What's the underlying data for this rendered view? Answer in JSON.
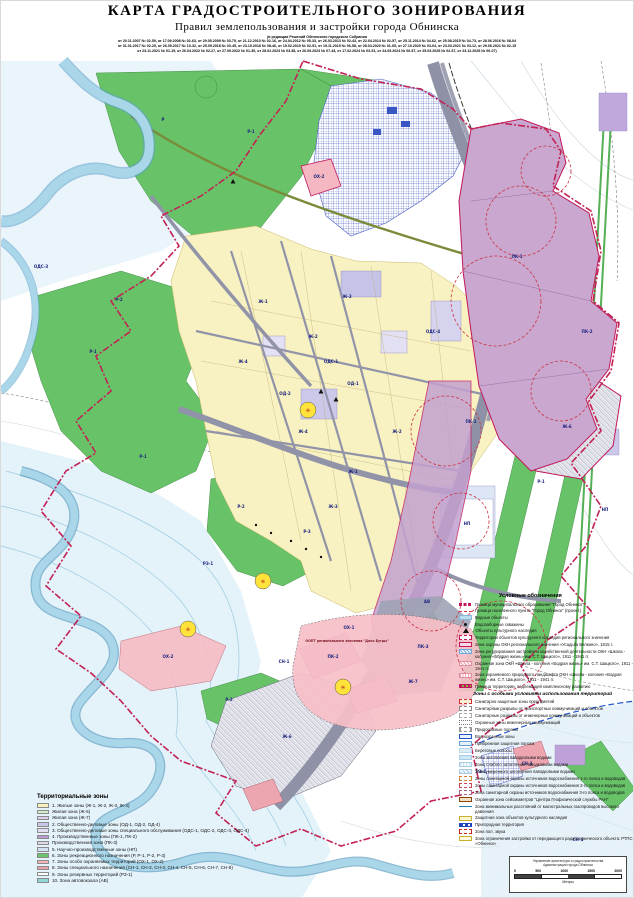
{
  "header": {
    "title": "КАРТА ГРАДОСТРОИТЕЛЬНОГО ЗОНИРОВАНИЯ",
    "subtitle": "Правил землепользования и застройки города  Обнинска",
    "edition_note": "(в редакции Решений Обнинского городского Собрания",
    "amendments_line1": "от 20.11.2007 № 02-50, от 17.09.2008 № 02-63, от 29.05.2009 № 03-75, от 21.12.2010 № 02-16, от 24.04.2012 № 05-33, от 26.03.2013 № 02-43, от 22.04.2014 № 02-57, от 25.11.2014 № 04-62, от 25.08.2015 № 04-73, от 28.06.2016 № 08-04",
    "amendments_line2": "от 31.01.2017 № 02-25, от 26.09.2017 № 10-32, от 25.09.2018 № 03-45, от 23.10.2018 № 08-46, от 19.02.2019 № 02-51, от 19.11.2019 № 06-58, от 28.04.2020 № 01-65, от 27.10.2020 № 03-04, от 23.03.2021 № 03-12, от 29.06.2021 № 02-15",
    "amendments_line3": "от 23.11.2021 № 01-19, от 26.04.2022 № 02-27, от 27.09.2022 № 01-30, от 28.02.2023 № 03-38, от 26.09.2023 № 07-43, от 17.02.2024 № 03-51, от 24.09.2024 № 06-97, от 25.03.2025 № 02-67, от 23.12.2025 № 06-07)"
  },
  "map": {
    "zone_labels": [
      {
        "t": "Р-1",
        "x": 250,
        "y": 132
      },
      {
        "t": "Р",
        "x": 162,
        "y": 120
      },
      {
        "t": "Р-1",
        "x": 92,
        "y": 352
      },
      {
        "t": "Р-1",
        "x": 142,
        "y": 457
      },
      {
        "t": "Р-2",
        "x": 118,
        "y": 300
      },
      {
        "t": "Р-2",
        "x": 240,
        "y": 507
      },
      {
        "t": "Р-3",
        "x": 306,
        "y": 532
      },
      {
        "t": "Р-1",
        "x": 540,
        "y": 482
      },
      {
        "t": "Р-2",
        "x": 228,
        "y": 700
      },
      {
        "t": "Ж-1",
        "x": 262,
        "y": 302
      },
      {
        "t": "Ж-2",
        "x": 312,
        "y": 337
      },
      {
        "t": "Ж-3",
        "x": 346,
        "y": 297
      },
      {
        "t": "Ж-4",
        "x": 242,
        "y": 362
      },
      {
        "t": "Ж-1",
        "x": 352,
        "y": 472
      },
      {
        "t": "Ж-2",
        "x": 396,
        "y": 432
      },
      {
        "t": "Ж-3",
        "x": 332,
        "y": 507
      },
      {
        "t": "Ж-4",
        "x": 302,
        "y": 432
      },
      {
        "t": "Ж-6",
        "x": 566,
        "y": 427
      },
      {
        "t": "Ж-6",
        "x": 286,
        "y": 737
      },
      {
        "t": "Ж-7",
        "x": 412,
        "y": 682
      },
      {
        "t": "ОД-1",
        "x": 352,
        "y": 384
      },
      {
        "t": "ОД-2",
        "x": 284,
        "y": 394
      },
      {
        "t": "ОДС-1",
        "x": 330,
        "y": 362
      },
      {
        "t": "ОДС-3",
        "x": 40,
        "y": 267
      },
      {
        "t": "ОДС-4",
        "x": 432,
        "y": 332
      },
      {
        "t": "ПК-1",
        "x": 516,
        "y": 257
      },
      {
        "t": "ПК-1",
        "x": 470,
        "y": 422
      },
      {
        "t": "ПК-2",
        "x": 586,
        "y": 332
      },
      {
        "t": "ПК-2",
        "x": 332,
        "y": 657
      },
      {
        "t": "ПК-3",
        "x": 422,
        "y": 647
      },
      {
        "t": "НП",
        "x": 466,
        "y": 524
      },
      {
        "t": "НП",
        "x": 604,
        "y": 510
      },
      {
        "t": "ОХ-1",
        "x": 348,
        "y": 628
      },
      {
        "t": "ОХ-2",
        "x": 318,
        "y": 177
      },
      {
        "t": "ОХ-2",
        "x": 167,
        "y": 657
      },
      {
        "t": "СН-1",
        "x": 283,
        "y": 662
      },
      {
        "t": "СН-3",
        "x": 526,
        "y": 764
      },
      {
        "t": "СН-4",
        "x": 577,
        "y": 840
      },
      {
        "t": "РЗ-1",
        "x": 207,
        "y": 564
      },
      {
        "t": "РЗ-1",
        "x": 480,
        "y": 772
      },
      {
        "t": "АВ",
        "x": 426,
        "y": 602
      }
    ],
    "annotations": [
      {
        "t": "ООПТ регионального значения \"Дача Бугры\"",
        "x": 346,
        "y": 641
      }
    ]
  },
  "legend_zones": {
    "title": "Территориальные зоны",
    "items": [
      {
        "color": "#F8F1BE",
        "label": "1. Жилые зоны (Ж-1, Ж-2, Ж-3, Ж-4)"
      },
      {
        "color": "#D5EDCB",
        "label": "Жилая зона (Ж-6)"
      },
      {
        "color": "#D9D0EC",
        "label": "Жилая зона (Ж-7)"
      },
      {
        "color": "#C6C6E8",
        "label": "2. Общественно-деловые зоны (ОД-1, ОД-2, ОД-4)"
      },
      {
        "color": "#E2DEF2",
        "label": "3. Общественно-деловые зоны специального обслуживания (ОДС-1, ОДС-2, ОДС-3, ОДС-4)"
      },
      {
        "color": "#B79BD2",
        "label": "4. Производственные зоны (ПК-1, ПК-2)"
      },
      {
        "color": "#DCD9EA",
        "label": "Производственная зона (ПК-3)"
      },
      {
        "color": "#D2E2F2",
        "label": "5. Научно-производственные зоны (НП)"
      },
      {
        "color": "#6CC36C",
        "label": "6. Зоны рекреационного назначения (Р, Р-1, Р-2, Р-3)"
      },
      {
        "color": "#F4B4BC",
        "label": "7. Зоны особо охраняемых территорий (ОХ-1, ОХ-2)"
      },
      {
        "color": "#EBA0AC",
        "label": "8. Зоны специального назначения (СН-1, СН-2, СН-3, СН-4, СН-5, СН-6, СН-7, СН-8)"
      },
      {
        "color": "#FFFFFF",
        "label": "9. Зоны резервных территорий (РЗ-1)"
      },
      {
        "color": "#8FD8D8",
        "label": "10. Зона автовокзала (АВ)"
      }
    ]
  },
  "legend_symbols": {
    "title": "Условные обозначения",
    "items": [
      {
        "sym": "ln-red-bold-dash",
        "label": "Граница муниципального образования \"Город Обнинск\""
      },
      {
        "sym": "ln-red-dashdot",
        "label": "Граница населенного пункта \"Город Обнинск\" (проект.)"
      },
      {
        "sym": "fill-water",
        "label": "Водные объекты"
      },
      {
        "sym": "dot-black",
        "label": "Водозаборные скважины"
      },
      {
        "sym": "tri-black",
        "label": "Объекты культурного наследия"
      },
      {
        "sym": "bracket-magenta",
        "label": "Территории объектов культурного наследия регионального значения"
      },
      {
        "sym": "rect-magenta",
        "label": "Зона охраны ОКН регионального значения «Усадьба Белкино», 1815 г."
      },
      {
        "sym": "hatch-blue",
        "label": "Зона регулирования застройки и хозяйственной деятельности ОКН «Школа - колония «Бодрая жизнь» им. С.Т. Шацкого», 1911 - 1941 гг."
      },
      {
        "sym": "hatch-pink",
        "label": "Охранная зона ОКН «Школа - колония «Бодрая жизнь» им. С.Т. Шацкого», 1911 - 1941 гг."
      },
      {
        "sym": "dots-pink",
        "label": "Зона охраняемого природного ландшафта ОКН «Школа - колония «Бодрая жизнь» им. С.Т. Шацкого», 1911 - 1941 гг."
      },
      {
        "sym": "dash-magenta-green",
        "label": "Граница территории, подлежащей комплексному развитию"
      }
    ]
  },
  "special_zones": {
    "title": "Зоны с особыми условиями использования территорий",
    "items": [
      {
        "sym": "rect-red-dash",
        "label": "Санитарно-защитные зоны предприятий"
      },
      {
        "sym": "rect-gray-dash",
        "label": "Санитарные разрывы от транспортных коммуникаций и объектов"
      },
      {
        "sym": "rect-gray-dash2",
        "label": "Санитарные разрывы от инженерных коммуникаций и объектов"
      },
      {
        "sym": "rect-gray-dot",
        "label": "Охранные зоны инженерных коммуникаций"
      },
      {
        "sym": "bracket-gray",
        "label": "Придорожные полосы"
      },
      {
        "sym": "rect-blue-bold",
        "label": "Водоохранные зоны"
      },
      {
        "sym": "rect-blue-thin",
        "label": "Прибрежная защитная полоса"
      },
      {
        "sym": "fill-shore",
        "label": "Береговые полосы"
      },
      {
        "sym": "fill-flood",
        "label": "Зоны затопления паводковыми водами"
      },
      {
        "sym": "hatch-flood-light",
        "label": "Зоны слабого затопления паводковыми водами"
      },
      {
        "sym": "hatch-flood-mid",
        "label": "Зона умеренного затопления паводковыми водами"
      },
      {
        "sym": "rect-dash-zso1",
        "label": "Зоны санитарной охраны источников водоснабжения 1-го пояса и водоводов"
      },
      {
        "sym": "rect-dash-zso2",
        "label": "Зоны санитарной охраны источников водоснабжения 2-го пояса и водоводов"
      },
      {
        "sym": "rect-dash-zso3",
        "label": "Зона санитарной охраны источников водоснабжения 3-го пояса и водоводов"
      },
      {
        "sym": "rect-seismo",
        "label": "Охранная зона сейсмометров \"Центра Геофизической службы РАН\""
      },
      {
        "sym": "ln-teal",
        "label": "Зона минимальных расстояний от магистральных газопроводов высокого давления"
      },
      {
        "sym": "rect-yellow",
        "label": "Защитная зона объектов культурного наследия"
      },
      {
        "sym": "dash-blue-bold",
        "label": "Пригородная территория"
      },
      {
        "sym": "rect-red-dash2",
        "label": "Зона пол. звука"
      },
      {
        "sym": "rect-yellow2",
        "label": "Зона ограничения застройки от передающего радиотехнического объекта: РТПС «Обнинск»"
      }
    ]
  },
  "scalebar": {
    "org_line1": "Управление архитектуры и градостроительства",
    "org_line2": "Администрации города Обнинска",
    "ticks": [
      "0",
      "500",
      "1000",
      "1500",
      "2000"
    ],
    "units": "Метры"
  }
}
